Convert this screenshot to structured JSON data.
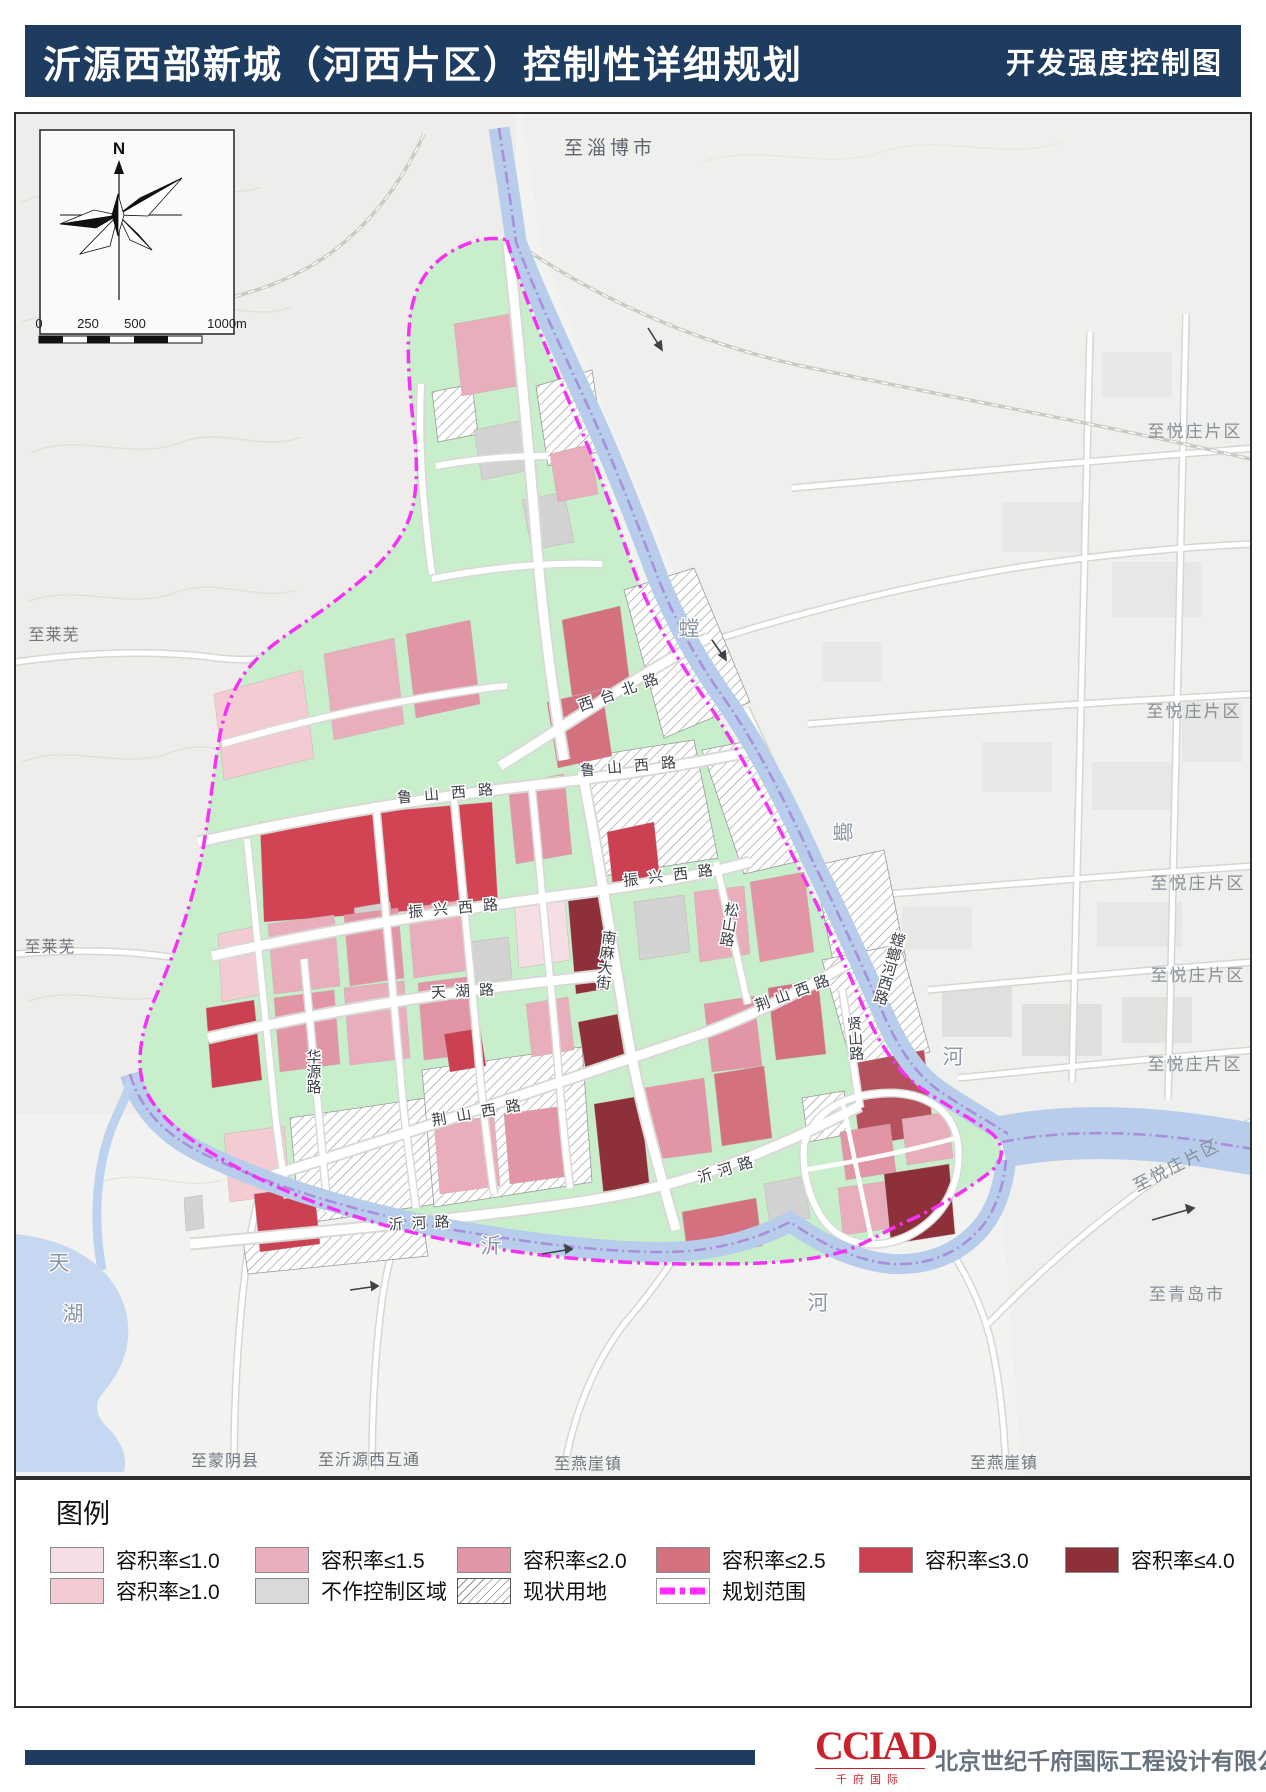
{
  "header": {
    "title": "沂源西部新城（河西片区）控制性详细规划",
    "map_type": "开发强度控制图"
  },
  "compass": {
    "north_label": "N"
  },
  "scale_bar": {
    "ticks": [
      "0",
      "250",
      "500",
      "1000m"
    ]
  },
  "legend": {
    "title": "图例",
    "items": [
      {
        "label": "容积率≤1.0",
        "color": "#f5dfe5",
        "type": "swatch"
      },
      {
        "label": "容积率≤1.5",
        "color": "#e9aebb",
        "type": "swatch"
      },
      {
        "label": "容积率≤2.0",
        "color": "#e295a5",
        "type": "swatch"
      },
      {
        "label": "容积率≤2.5",
        "color": "#d3717f",
        "type": "swatch"
      },
      {
        "label": "容积率≤3.0",
        "color": "#cb4151",
        "type": "swatch"
      },
      {
        "label": "容积率≤4.0",
        "color": "#8e3039",
        "type": "swatch"
      },
      {
        "label": "容积率≥1.0",
        "color": "#f3cbd3",
        "type": "swatch"
      },
      {
        "label": "不作控制区域",
        "color": "#d9d9d9",
        "type": "swatch"
      },
      {
        "label": "现状用地",
        "color": "hatch-pattern",
        "type": "hatch"
      },
      {
        "label": "规划范围",
        "color": "#ff2bff",
        "type": "boundary-line"
      }
    ]
  },
  "map": {
    "context_labels": [
      {
        "text": "至淄博市"
      },
      {
        "text": "至悦庄片区"
      },
      {
        "text": "至悦庄片区"
      },
      {
        "text": "至悦庄片区"
      },
      {
        "text": "至悦庄片区"
      },
      {
        "text": "至悦庄片区"
      },
      {
        "text": "至悦庄片区"
      },
      {
        "text": "至莱芜"
      },
      {
        "text": "至莱芜"
      },
      {
        "text": "至蒙阴县"
      },
      {
        "text": "至沂源西互通"
      },
      {
        "text": "至燕崖镇"
      },
      {
        "text": "至燕崖镇"
      },
      {
        "text": "至青岛市"
      }
    ],
    "street_labels": [
      {
        "text": "西台北路"
      },
      {
        "text": "鲁山西路"
      },
      {
        "text": "鲁山西路"
      },
      {
        "text": "振兴西路"
      },
      {
        "text": "振兴西路"
      },
      {
        "text": "天湖路"
      },
      {
        "text": "华源路"
      },
      {
        "text": "荆山西路"
      },
      {
        "text": "荆山西路"
      },
      {
        "text": "南麻大街"
      },
      {
        "text": "松山路"
      },
      {
        "text": "贤山路"
      },
      {
        "text": "螳螂河西路"
      },
      {
        "text": "沂河路"
      },
      {
        "text": "沂河路"
      }
    ],
    "water_labels": [
      {
        "text": "螳"
      },
      {
        "text": "螂"
      },
      {
        "text": "河"
      },
      {
        "text": "沂"
      },
      {
        "text": "河"
      },
      {
        "text": "天"
      },
      {
        "text": "湖"
      }
    ]
  },
  "footer": {
    "logo_text": "CCIAD",
    "logo_sub": "千府国际",
    "company": "北京世纪千府国际工程设计有限公司"
  },
  "colors": {
    "title_bar": "#1e3c60",
    "planning_boundary": "#f531f5",
    "river": "#b7cdeb",
    "green_space": "#c8eecb",
    "river_guideline": "#a98fd9"
  }
}
